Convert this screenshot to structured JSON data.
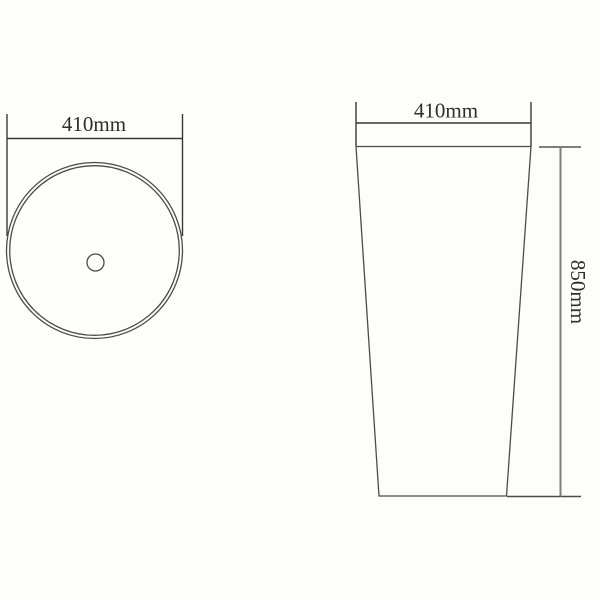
{
  "colors": {
    "background": "#fdfdfa",
    "line_dark": "#383838",
    "line_medium": "#4c4c4c",
    "line_gray": "#7d7d7d",
    "text_color": "#2e2e2e"
  },
  "top_view": {
    "diameter_label": "410mm"
  },
  "front_view": {
    "width_label": "410mm",
    "height_label": "850mm"
  }
}
